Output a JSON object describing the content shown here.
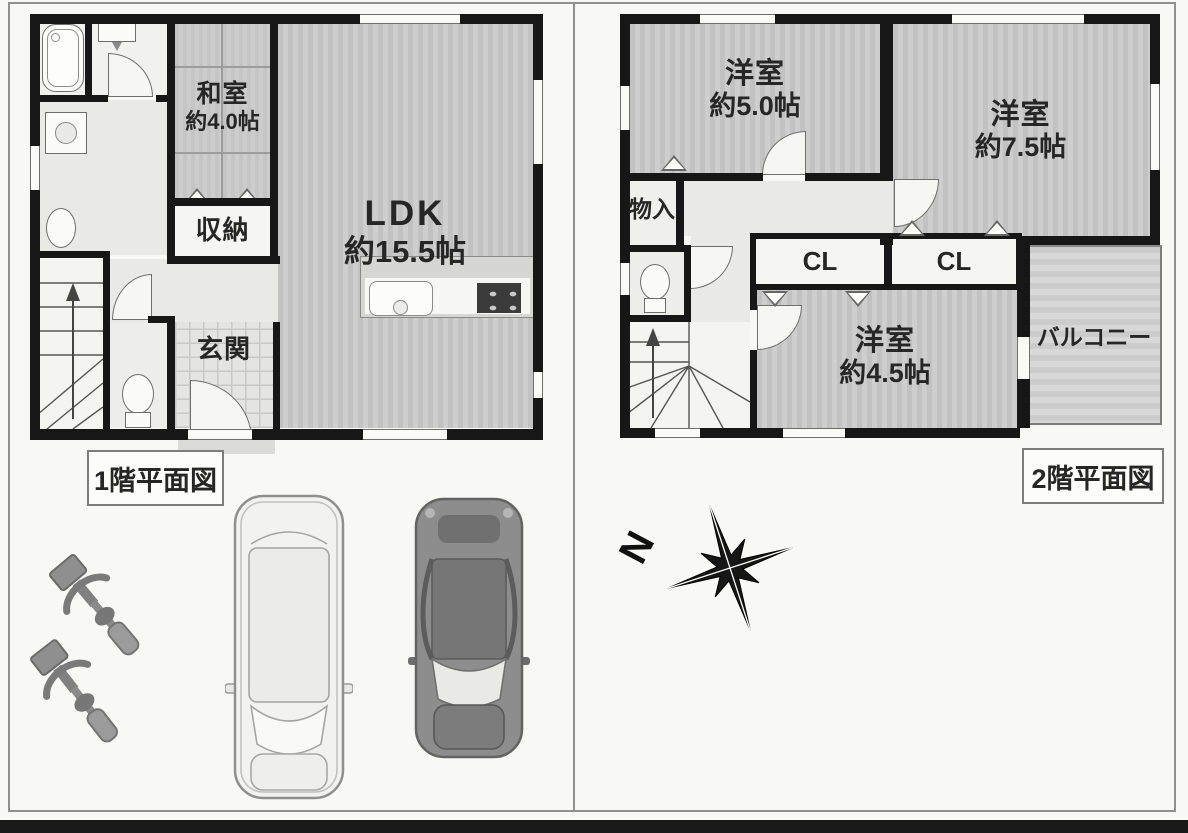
{
  "floor1": {
    "plan_label": "1階平面図",
    "washitsu_name": "和室",
    "washitsu_size": "約4.0帖",
    "ldk_name": "LDK",
    "ldk_size": "約15.5帖",
    "storage_label": "収納",
    "genkan_label": "玄関"
  },
  "floor2": {
    "plan_label": "2階平面図",
    "bedroom5_name": "洋室",
    "bedroom5_size": "約5.0帖",
    "bedroom75_name": "洋室",
    "bedroom75_size": "約7.5帖",
    "bedroom45_name": "洋室",
    "bedroom45_size": "約4.5帖",
    "closet1_label": "CL",
    "closet2_label": "CL",
    "storage_label": "物入",
    "balcony_label": "バルコニー"
  },
  "compass": {
    "north_label": "N"
  },
  "colors": {
    "wall": "#171717",
    "room_floor": "#c8c8c8",
    "hall_floor": "#e9e9e7",
    "balcony_floor": "#d2d2d2",
    "frame_border": "#909090"
  }
}
